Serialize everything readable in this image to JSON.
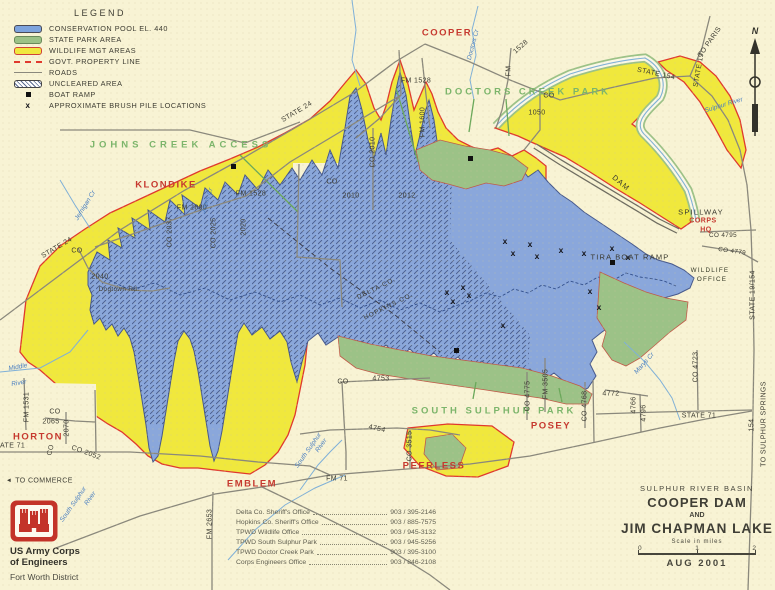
{
  "legend": {
    "title": "LEGEND",
    "items": [
      {
        "key": "pool",
        "label": "CONSERVATION POOL EL. 440"
      },
      {
        "key": "park",
        "label": "STATE PARK AREA"
      },
      {
        "key": "wildlife",
        "label": "WILDLIFE MGT AREAS"
      },
      {
        "key": "property",
        "label": "GOVT. PROPERTY LINE"
      },
      {
        "key": "roads",
        "label": "ROADS"
      },
      {
        "key": "uncleared",
        "label": "UNCLEARED AREA"
      },
      {
        "key": "boat",
        "label": "BOAT RAMP"
      },
      {
        "key": "brush",
        "label": "APPROXIMATE BRUSH PILE LOCATIONS"
      }
    ]
  },
  "towns": {
    "cooper": "COOPER",
    "klondike": "KLONDIKE",
    "horton": "HORTON",
    "emblem": "EMBLEM",
    "peerless": "PEERLESS",
    "posey": "POSEY",
    "corps1": "CORPS",
    "corps2": "HQ"
  },
  "parks": {
    "johns": "JOHNS CREEK ACCESS",
    "doctors": "DOCTORS CREEK PARK",
    "south": "SOUTH SULPHUR PARK",
    "wild1": "WILDLIFE",
    "wild2": "OFFICE"
  },
  "features": {
    "spillway": "SPILLWAY",
    "tira": "TIRA BOAT RAMP",
    "dam": "DAM",
    "delta": "DELTA CO.",
    "hopkins": "HOPKINS CO."
  },
  "roads": {
    "state24_a": "STATE 24",
    "state24_b": "STATE 24",
    "state154": "STATE 154",
    "state19": "STATE 19",
    "to_paris": "TO PARIS",
    "state19_154": "STATE 19/154",
    "state71_a": "STATE 71",
    "state71_b": "STATE 71",
    "h154": "154",
    "to_sulphur_springs": "TO SULPHUR SPRINGS",
    "to_commerce": "TO COMMERCE",
    "arrow_w": "◄",
    "fm71": "FM  71",
    "fm1528_a": "FM 1528",
    "fm1528_b": "FM 1528",
    "fm_v": "FM",
    "n1528": "1528",
    "fm2890": "FM 2890",
    "co2037": "CO 2037",
    "co2025": "CO 2025",
    "n2020": "2020",
    "co2010_v": "CO 2010",
    "co_a": "CO",
    "n2010": "2010",
    "n2012": "2012",
    "fm1600": "FM 1600",
    "co_b": "CO",
    "n1050": "1050",
    "co_c": "CO",
    "n2040": "2040",
    "dogtown": "Dogtown Rd.",
    "fm1531": "FM 1531",
    "co_d": "CO",
    "n2065": "2065",
    "n2070": "2070",
    "co_e": "CO",
    "co2052": "CO 2052",
    "fm2653": "FM 2653",
    "co_f": "CO",
    "n4753": "4753",
    "n4754": "4754",
    "co3515": "CO 3515",
    "co4775": "CO 4775",
    "fm3505": "FM 3505",
    "co4768": "CO 4768",
    "n4772": "4772",
    "n4766": "4766",
    "n4796": "4796",
    "co4723": "CO 4723",
    "co4795": "CO 4795",
    "co4779": "CO 4779"
  },
  "creeks": {
    "middle": "Middle",
    "sulphur": "Sulphur",
    "river": "River",
    "south_a1": "South Sulphur",
    "south_a2": "River",
    "south_b1": "South Sulphur",
    "south_b2": "River",
    "sulphur_river": "Sulphur River",
    "marys": "Marys Cr",
    "jernigan": "Jernigan Cr",
    "johns": "Johns Cr",
    "doctors": "Doctors Cr"
  },
  "markers": {
    "brush": "x"
  },
  "north": {
    "label": "N"
  },
  "phones": {
    "rows": [
      {
        "name": "Delta Co. Sheriff's Office",
        "num": "903 / 395-2146"
      },
      {
        "name": "Hopkins Co. Sheriff's Office",
        "num": "903 / 885-7575"
      },
      {
        "name": "TPWD Wildlife Office",
        "num": "903 / 945-3132"
      },
      {
        "name": "TPWD South Sulphur Park",
        "num": "903 / 945-5256"
      },
      {
        "name": "TPWD Doctor Creek Park",
        "num": "903 / 395-3100"
      },
      {
        "name": "Corps Engineers Office",
        "num": "903 / 846-2108"
      }
    ]
  },
  "title_block": {
    "basin": "SULPHUR RIVER BASIN",
    "line1": "COOPER DAM",
    "and": "AND",
    "line2": "JIM CHAPMAN LAKE",
    "scale_label": "Scale in miles",
    "s0": "0",
    "s1": "1",
    "s2": "2",
    "date": "AUG 2001"
  },
  "agency": {
    "l1": "US Army Corps",
    "l2": "of Engineers",
    "l3": "Fort Worth District"
  }
}
